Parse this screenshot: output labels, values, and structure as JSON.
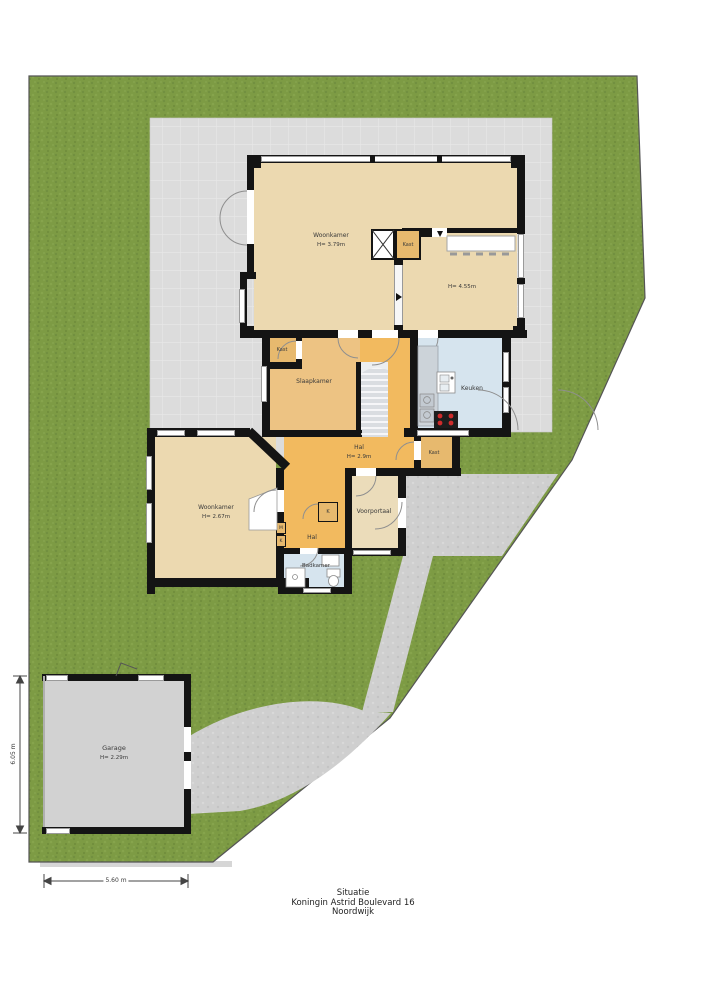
{
  "title_block": {
    "line1": "Situatie",
    "line2": "Koningin Astrid Boulevard 16",
    "line3": "Noordwijk"
  },
  "floorplan": {
    "rooms": [
      {
        "name": "woonkamer-boven",
        "label": "Woonkamer",
        "height": "H= 3.79m"
      },
      {
        "name": "eethoek",
        "label": "",
        "height": "H= 4.55m"
      },
      {
        "name": "kast-woonkamer",
        "label": "Kast",
        "height": ""
      },
      {
        "name": "slaapkamer",
        "label": "Slaapkamer",
        "height": ""
      },
      {
        "name": "kast-slaapkamer",
        "label": "Kast",
        "height": ""
      },
      {
        "name": "keuken",
        "label": "Keuken",
        "height": ""
      },
      {
        "name": "hal-boven",
        "label": "Hal",
        "height": "H= 2.9m"
      },
      {
        "name": "kast-hal",
        "label": "Kast",
        "height": ""
      },
      {
        "name": "woonkamer-beneden",
        "label": "Woonkamer",
        "height": "H= 2.67m"
      },
      {
        "name": "voorportaal",
        "label": "Voorportaal",
        "height": ""
      },
      {
        "name": "hal-beneden",
        "label": "Hal",
        "height": ""
      },
      {
        "name": "badkamer",
        "label": "Badkamer",
        "height": ""
      },
      {
        "name": "kast-k",
        "label": "K",
        "height": ""
      },
      {
        "name": "meterkast",
        "label": "M",
        "height": ""
      },
      {
        "name": "kast-k2",
        "label": "K",
        "height": ""
      },
      {
        "name": "garage",
        "label": "Garage",
        "height": "H= 2.29m"
      }
    ],
    "dimensions": {
      "garage_width": "5.60 m",
      "garage_depth": "6.05 m"
    },
    "colors": {
      "grass": "#7d9b44",
      "patio": "#dcdcdc",
      "paving": "#cfcfcf",
      "floor_beige": "#ecd9b0",
      "floor_tan": "#edc383",
      "floor_orange": "#f2ba5f",
      "floor_blue": "#d6e4ee",
      "wall": "#141414"
    },
    "labels": [
      {
        "text": "Woonkamer",
        "x": 331,
        "y": 236,
        "fs": 6
      },
      {
        "text": "H= 3.79m",
        "x": 331,
        "y": 244,
        "fs": 5.5
      },
      {
        "text": "Kast",
        "x": 408,
        "y": 245,
        "fs": 5
      },
      {
        "text": "H= 4.55m",
        "x": 462,
        "y": 286,
        "fs": 5.5
      },
      {
        "text": "Kast",
        "x": 282,
        "y": 350,
        "fs": 5
      },
      {
        "text": "Slaapkamer",
        "x": 314,
        "y": 382,
        "fs": 6
      },
      {
        "text": "Keuken",
        "x": 472,
        "y": 389,
        "fs": 6
      },
      {
        "text": "Hal",
        "x": 359,
        "y": 448,
        "fs": 6
      },
      {
        "text": "H= 2.9m",
        "x": 359,
        "y": 456,
        "fs": 5.5
      },
      {
        "text": "Kast",
        "x": 434,
        "y": 453,
        "fs": 5
      },
      {
        "text": "Woonkamer",
        "x": 216,
        "y": 508,
        "fs": 6
      },
      {
        "text": "H= 2.67m",
        "x": 216,
        "y": 516,
        "fs": 5.5
      },
      {
        "text": "Voorportaal",
        "x": 374,
        "y": 512,
        "fs": 6
      },
      {
        "text": "Hal",
        "x": 312,
        "y": 538,
        "fs": 6
      },
      {
        "text": "Badkamer",
        "x": 316,
        "y": 565,
        "fs": 5.5
      },
      {
        "text": "K",
        "x": 328,
        "y": 512,
        "fs": 5
      },
      {
        "text": "M",
        "x": 281,
        "y": 528,
        "fs": 4.5
      },
      {
        "text": "K",
        "x": 281,
        "y": 541,
        "fs": 4.5
      },
      {
        "text": "Garage",
        "x": 114,
        "y": 748,
        "fs": 6.5
      },
      {
        "text": "H= 2.29m",
        "x": 114,
        "y": 757,
        "fs": 5.5
      },
      {
        "text": "5.60 m",
        "x": 116,
        "y": 881,
        "fs": 6,
        "bg": true
      },
      {
        "text": "6.05 m",
        "x": 14,
        "y": 754,
        "fs": 6,
        "rot": -90,
        "bg": true
      }
    ]
  }
}
